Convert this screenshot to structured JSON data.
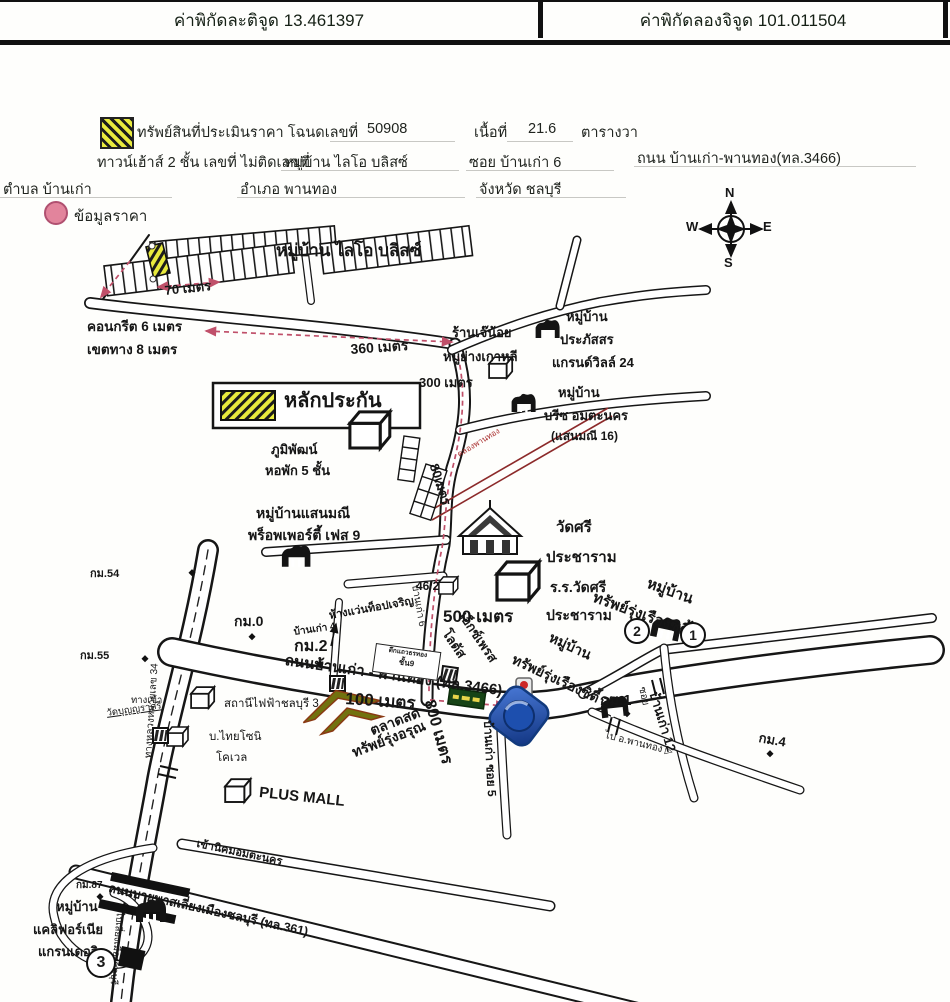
{
  "header": {
    "latitude": "ค่าพิกัดละติจูด 13.461397",
    "longitude": "ค่าพิกัดลองจิจูด 101.011504"
  },
  "property": {
    "line1_label": "ทรัพย์สินที่ประเมินราคา โฉนดเลขที่",
    "deed_no": "50908",
    "area_label": "เนื้อที่",
    "area_value": "21.6",
    "area_unit": "ตารางวา",
    "line2_type": "ทาวน์เฮ้าส์ 2 ชั้น เลขที่ ไม่ติดเลขที่",
    "village": "หมู่บ้าน ไลโอ บลิสซ์",
    "soi": "ซอย บ้านเก่า 6",
    "road": "ถนน บ้านเก่า-พานทอง(ทล.3466)",
    "tambon": "ตำบล บ้านเก่า",
    "amphoe": "อำเภอ พานทอง",
    "province": "จังหวัด ชลบุรี",
    "price_info": "ข้อมูลราคา"
  },
  "legend": {
    "collateral": "หลักประกัน"
  },
  "compass": {
    "n": "N",
    "e": "E",
    "s": "S",
    "w": "W"
  },
  "markers": {
    "no1": "1",
    "no2": "2",
    "no3": "3"
  },
  "colors": {
    "hatch_yellow": "#e8ea3d",
    "route_red": "#c0506a",
    "canal_red": "#8c2a2a",
    "pink_circle": "#e2849c",
    "lotus_green": "#174417",
    "landmark_blue": "#1d4fae",
    "market_olive": "#72720f"
  },
  "map": {
    "labels": {
      "lio_bliss": "หมู่บ้าน ไลโอ บลิสซ์",
      "m70": "70 เมตร",
      "concrete": "คอนกรีต 6 เมตร",
      "roadwidth": "เขตทาง 8 เมตร",
      "m360": "360 เมตร",
      "m300": "300 เมตร",
      "m500": "500 เมตร",
      "m100": "100 เมตร",
      "m800": "800 เมตร",
      "m80": "80เมตร",
      "jenoi1": "ร้านเจ๊น้อย",
      "jenoi2": "หมูย่างเกาหลี",
      "prapat1": "หมู่บ้าน",
      "prapat2": "ประภัสสร",
      "prapat3": "แกรนด์วิลล์ 24",
      "breeze1": "หมู่บ้าน",
      "breeze2": "บรีซ อมตะนคร",
      "breeze3": "(แสนมณี 16)",
      "phumi1": "ภูมิพัฒน์",
      "phumi2": "หอพัก 5 ชั้น",
      "canal": "คลองพานทอง",
      "sanmanee1": "หมู่บ้านแสนมณี",
      "sanmanee2": "พร็อพเพอร์ตี้ เฟส 9",
      "watsri1": "วัดศรี",
      "watsri2": "ประชาราม",
      "school1": "ร.ร.วัดศรี",
      "school2": "ประชาราม",
      "house462": "46/2",
      "km54": "กม.54",
      "km55": "กม.55",
      "km0": "กม.0",
      "km2": "กม.2",
      "km1": "กม.1",
      "km4": "กม.4",
      "km87": "กม.87",
      "top_charoen": "ห้างแว่นท็อปเจริญ",
      "bankao4": "บ้านเก่า 4",
      "soi6_road": "บ้านเก่า 6",
      "roadname": "ถนนบ้านเก่า - พานทอง (ทล.3466)",
      "power_station": "สถานีไฟฟ้าชลบุรี 3",
      "thaisoni1": "บ.ไทยโซนิ",
      "thaisoni2": "โคเวล",
      "entrance": "ทางเข้า",
      "wat": "วัดบุญญราศรี",
      "hwy34": "ทางหลวงหมายเลข 34",
      "lotus1": "โลตัส",
      "lotus2": "เอ็กซ์เพรส",
      "city2a": "หมู่บ้าน",
      "city2b": "ทรัพย์รุ่งเรืองซิตี้ 2",
      "city1a": "หมู่บ้าน",
      "city1b": "ทรัพย์รุ่งเรืองซิตี้",
      "soi_word": "ซอย",
      "bankao12": "บ้านเก่า 12",
      "pantong_dir": "ไป อ.พานทอง ▷",
      "market1": "ตลาดสด",
      "market2": "ทรัพย์รุ่งอรุณ",
      "soi5": "บ้านเก่า ซอย 5",
      "plusmall": "PLUS MALL",
      "amata": "เข้านิคมอมตะนคร",
      "bypass": "ถนนบายพาสเลี่ยงเมืองชลบุรี (ทล.361)",
      "cal1": "หมู่บ้าน",
      "cal2": "แคลิฟอร์เนีย",
      "cal3": "แกรนเดอวิว",
      "bypass_dir": "ไปเลี่ยงเมืองชลบุรี",
      "shophouse_name": "ตึกแถวธรทอง",
      "shophouse_floor": "ชั้น9"
    }
  }
}
